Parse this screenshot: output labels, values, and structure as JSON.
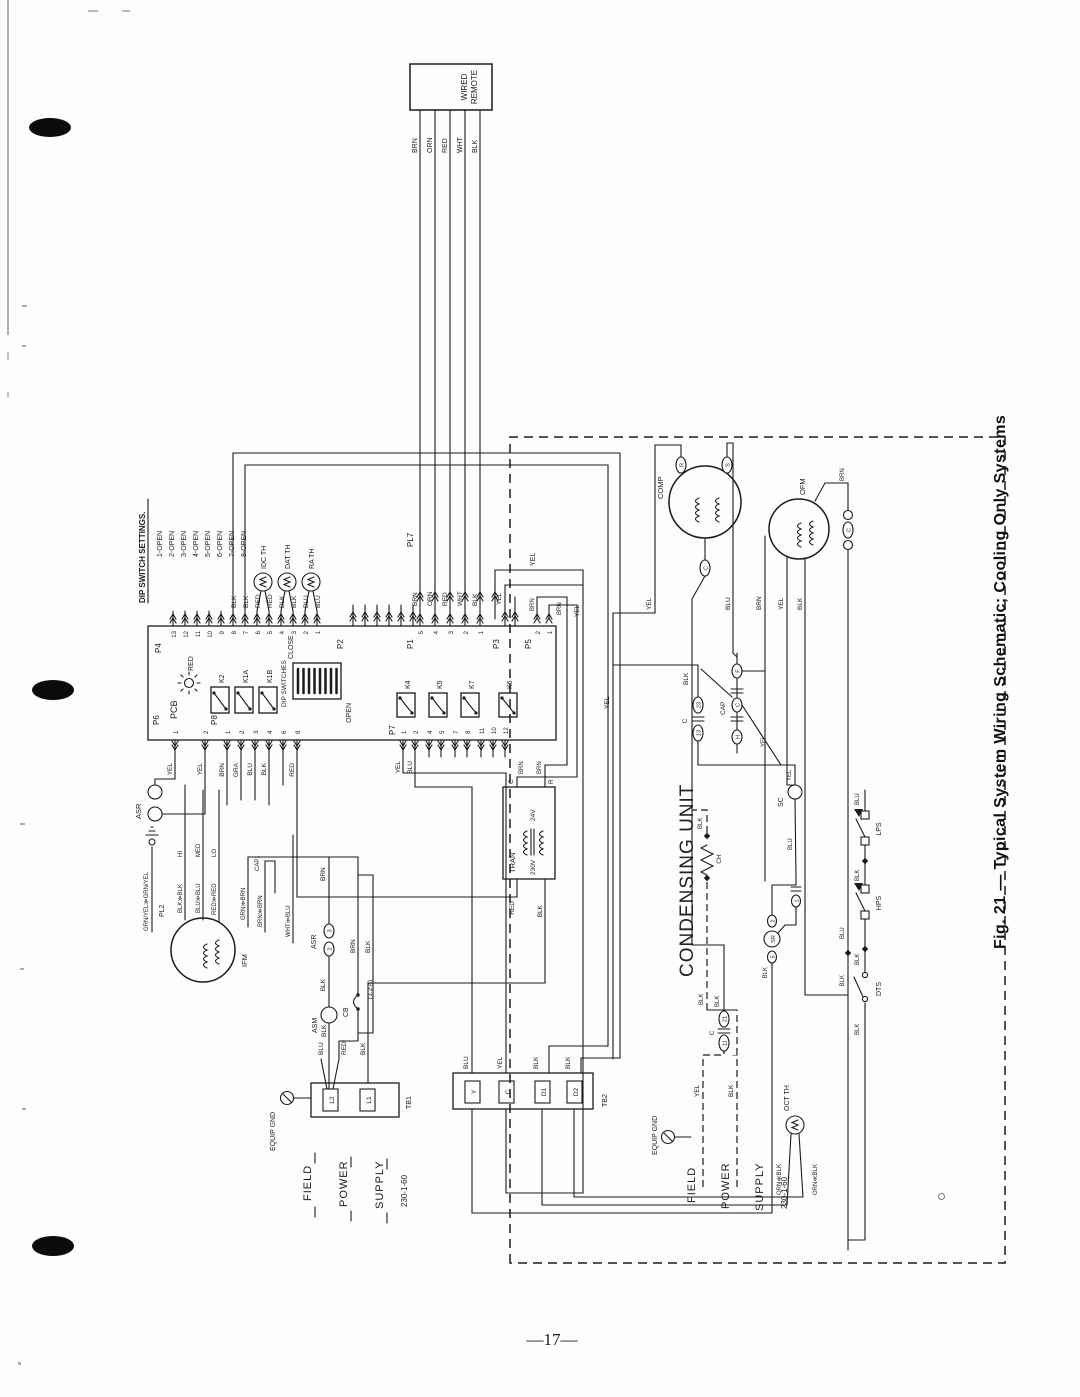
{
  "page": {
    "number": "—17—",
    "caption": "Fig. 21 — Typical System Wiring Schematic; Cooling Only Systems"
  },
  "colors": {
    "yel": "YEL",
    "blk": "BLK",
    "blu": "BLU",
    "brn": "BRN",
    "red": "RED",
    "orn": "ORN",
    "gra": "GRA",
    "wht": "WHT"
  },
  "remote": {
    "line1": "WIRED",
    "line2": "REMOTE",
    "wires": [
      "BRN",
      "ORN",
      "RED",
      "WHT",
      "BLK"
    ]
  },
  "dip_settings": {
    "heading": "DIP SWITCH SETTINGS.",
    "items": [
      "1-OPEN",
      "2-OPEN",
      "3-OPEN",
      "4-OPEN",
      "5-OPEN",
      "6-OPEN",
      "7-OPEN",
      "8-OPEN"
    ]
  },
  "pcb": {
    "name": "PCB",
    "led_label": "RED",
    "connectors": {
      "p4": "P4",
      "p2": "P2",
      "p1": "P1",
      "p3": "P3",
      "p5": "P5",
      "p6": "P6",
      "p7": "P7",
      "p8": "P8",
      "pl7": "PL7",
      "pl2": "PL2"
    },
    "p4_pins": [
      "13",
      "12",
      "11",
      "10",
      "9",
      "8",
      "7",
      "6",
      "5",
      "4",
      "3",
      "2",
      "1"
    ],
    "p4_wires": [
      "BLK",
      "BLK",
      "RED",
      "RED",
      "BLK",
      "BLK",
      "BLU",
      "BLU"
    ],
    "p1_pins": [
      "5",
      "4",
      "3",
      "2",
      "1"
    ],
    "p5_pins": [
      "2",
      "1"
    ],
    "p5_wires": [
      "BRN",
      "BRN"
    ],
    "p6_pins": [
      "1",
      "2"
    ],
    "p7_pins": [
      "1",
      "2",
      "4",
      "5",
      "7",
      "8",
      "11",
      "10",
      "12"
    ],
    "p8_pins": [
      "1",
      "2",
      "3",
      "4",
      "6",
      "8"
    ],
    "p8_wires": [
      "BRN",
      "GRA",
      "BLU",
      "BLK",
      "RED"
    ],
    "relays": {
      "k2": "K2",
      "k1a": "K1A",
      "k1b": "K1B",
      "k4": "K4",
      "k5": "K5",
      "k7": "K7",
      "k6": "K6"
    },
    "dip_block": {
      "label": "DIP SWITCHES",
      "close": "CLOSE",
      "open": "OPEN"
    }
  },
  "thermistors": {
    "idc": "IDC TH",
    "dat": "DAT TH",
    "ra": "RA TH"
  },
  "ifm": {
    "name": "IFM",
    "cap": "CAP1",
    "wires": [
      "GRN/YEL≫GRN/YEL",
      "BLK≫BLK",
      "BLU≫BLU",
      "RED≫RED",
      "GRN≫BRN",
      "BRN≫BRN",
      "WHT≫BLU"
    ],
    "speeds": {
      "hi": "HI",
      "med": "MED",
      "lo": "LO"
    }
  },
  "asr": {
    "name": "ASR",
    "t2": "2",
    "t3": "3"
  },
  "asm": "ASM",
  "cb": {
    "name": "CB",
    "rating": "(3.2 A)"
  },
  "tran": {
    "name": "TRAN",
    "v24": "24V",
    "v230": "230V",
    "c": "C",
    "r": "R"
  },
  "tb1": {
    "name": "TB1",
    "l1": "L1",
    "l2": "L2"
  },
  "tb2": {
    "name": "TB2",
    "y": "Y",
    "c": "C",
    "d1": "D1",
    "d2": "D2"
  },
  "field": {
    "equip_gnd": "EQUIP GND",
    "field": "FIELD",
    "power": "POWER",
    "supply": "SUPPLY",
    "rating": "230-1-60"
  },
  "cu": {
    "title": "CONDENSING UNIT",
    "comp": {
      "name": "COMP",
      "r": "R",
      "s": "S",
      "c": "C"
    },
    "ofm": "OFM",
    "run_cap": "C",
    "cap": {
      "name": "CAP",
      "f": "F",
      "c": "C",
      "h": "H"
    },
    "contactor": {
      "name": "C",
      "l": "L",
      "t23": "23",
      "t13": "13",
      "t21": "21",
      "t11": "11"
    },
    "sc": "SC",
    "sr": {
      "name": "SR",
      "t5": "5",
      "t2": "2",
      "t1": "1"
    },
    "ch": "CH",
    "lps": "LPS",
    "hps": "HPS",
    "dts": "DTS",
    "oct": {
      "name": "OCT TH",
      "wire": "ORN≪BLK"
    }
  }
}
